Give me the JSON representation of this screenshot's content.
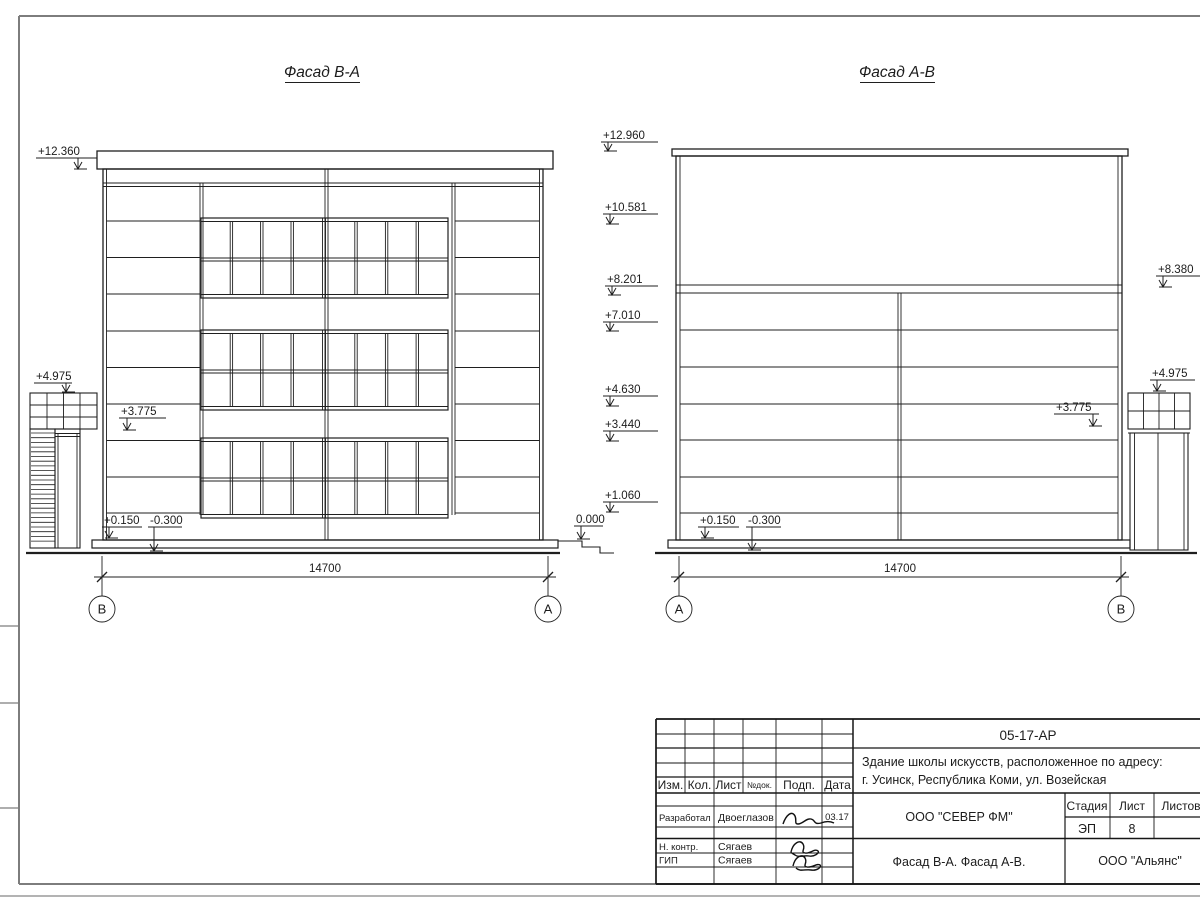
{
  "drawing": {
    "left_facade": {
      "title": "Фасад В-А",
      "elevations": [
        "+12.360",
        "+4.975",
        "+3.775",
        "+0.150",
        "-0.300",
        "0.000"
      ],
      "dimension": "14700",
      "axis_left": "В",
      "axis_right": "А"
    },
    "right_facade": {
      "title": "Фасад А-В",
      "elevations_left": [
        "+12.960",
        "+10.581",
        "+8.201",
        "+7.010",
        "+4.630",
        "+3.440",
        "+1.060"
      ],
      "elevations_right": [
        "+8.380",
        "+4.975",
        "+3.775"
      ],
      "elevations_base": [
        "+0.150",
        "-0.300"
      ],
      "dimension": "14700",
      "axis_left": "А",
      "axis_right": "В"
    },
    "title_block": {
      "doc_number": "05-17-АР",
      "project_address_line1": "Здание школы искусств, расположенное по адресу:",
      "project_address_line2": "г. Усинск, Республика Коми, ул. Возейская",
      "col_izm": "Изм.",
      "col_kol": "Кол.",
      "col_list": "Лист",
      "col_ndok": "№док.",
      "col_podp": "Подп.",
      "col_data": "Дата",
      "row1_role": "Разработал",
      "row1_name": "Двоеглазов",
      "row1_date": "03.17",
      "row2_role": "Н. контр.",
      "row2_name": "Сягаев",
      "row3_role": "ГИП",
      "row3_name": "Сягаев",
      "designer_company": "ООО \"СЕВЕР ФМ\"",
      "stage_label": "Стадия",
      "list_label": "Лист",
      "listov_label": "Листов",
      "stage_value": "ЭП",
      "list_value": "8",
      "sheet_caption": "Фасад В-А. Фасад А-В.",
      "contractor_company": "ООО \"Альянс\""
    }
  }
}
